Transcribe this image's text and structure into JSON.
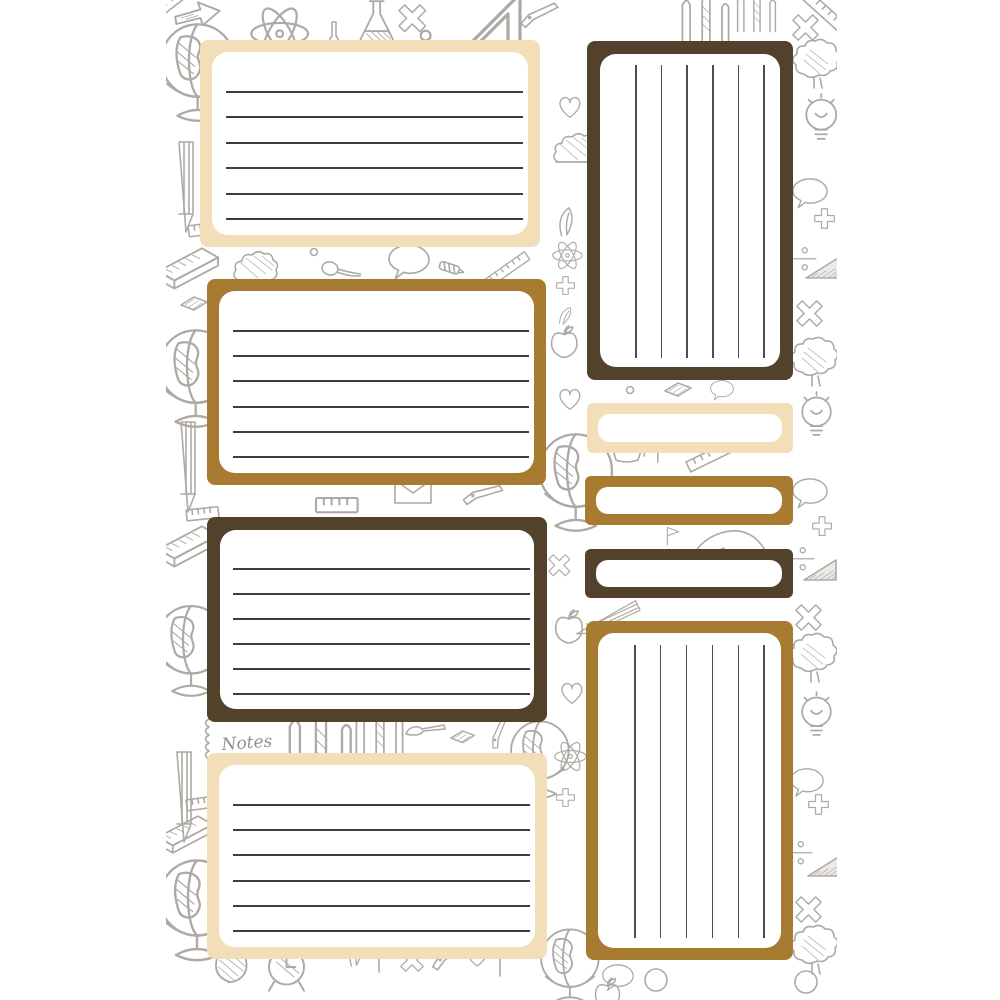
{
  "page": {
    "type": "printable-note-labels-sheet",
    "theme": "school-doodles"
  },
  "background": {
    "notes_label": "Notes",
    "doodle_icons": [
      "globe",
      "pencil",
      "book",
      "ruler",
      "atom",
      "flask",
      "bottle",
      "x-mark",
      "plus-sign",
      "heart",
      "light-bulb",
      "speech-bubble",
      "tree",
      "division-sign",
      "triangle",
      "spoon",
      "bush",
      "envelope",
      "leaf",
      "teacup",
      "flag",
      "alarm-clock",
      "apple",
      "pen",
      "paintbrush",
      "arrow",
      "notebook-spiral",
      "eraser",
      "sprout",
      "backpack",
      "circle",
      "set-square",
      "screw",
      "fence-posts"
    ]
  },
  "colors": {
    "page_background": "#ffffff",
    "cream_border": "#f2dfba",
    "golden_brown_border": "#a87c30",
    "dark_brown_border": "#53422b",
    "card_fill": "#ffffff",
    "rule_line": "#3d3d40",
    "vertical_rule_line": "#4c4c52",
    "doodle_stroke": "#a7a29c",
    "notes_text": "#8b8680"
  },
  "cards": [
    {
      "id": "note-card-1",
      "border_color_name": "cream",
      "orientation": "horizontal",
      "ruled_lines": 6
    },
    {
      "id": "note-card-2",
      "border_color_name": "golden-brown",
      "orientation": "horizontal",
      "ruled_lines": 6
    },
    {
      "id": "note-card-3",
      "border_color_name": "dark-brown",
      "orientation": "horizontal",
      "ruled_lines": 6
    },
    {
      "id": "note-card-4",
      "border_color_name": "cream",
      "orientation": "horizontal",
      "ruled_lines": 6
    },
    {
      "id": "tall-card-1",
      "border_color_name": "dark-brown",
      "orientation": "vertical",
      "ruled_lines": 6
    },
    {
      "id": "label-bar-1",
      "border_color_name": "cream",
      "orientation": "none",
      "ruled_lines": 0
    },
    {
      "id": "label-bar-2",
      "border_color_name": "golden-brown",
      "orientation": "none",
      "ruled_lines": 0
    },
    {
      "id": "label-bar-3",
      "border_color_name": "dark-brown",
      "orientation": "none",
      "ruled_lines": 0
    },
    {
      "id": "tall-card-2",
      "border_color_name": "golden-brown",
      "orientation": "vertical",
      "ruled_lines": 6
    }
  ]
}
